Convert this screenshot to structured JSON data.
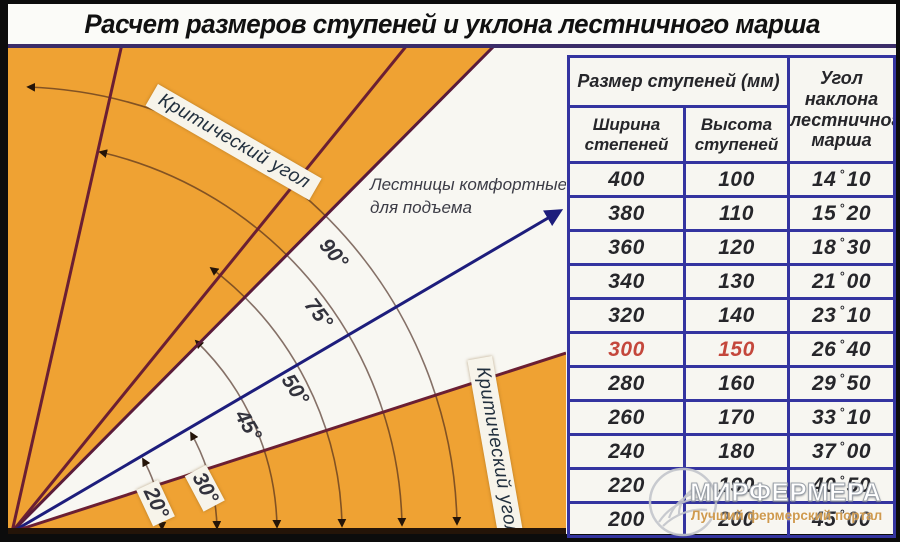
{
  "title": "Расчет размеров ступеней и уклона лестничного марша",
  "table": {
    "header_size": "Размер ступеней (мм)",
    "header_angle": "Угол наклона лестничного марша",
    "sub_width": "Ширина степеней",
    "sub_height": "Высота ступеней",
    "degree_symbol": "°",
    "rows": [
      {
        "w": "400",
        "h": "100",
        "deg": "14",
        "min": "10"
      },
      {
        "w": "380",
        "h": "110",
        "deg": "15",
        "min": "20"
      },
      {
        "w": "360",
        "h": "120",
        "deg": "18",
        "min": "30"
      },
      {
        "w": "340",
        "h": "130",
        "deg": "21",
        "min": "00"
      },
      {
        "w": "320",
        "h": "140",
        "deg": "23",
        "min": "10"
      },
      {
        "w": "300",
        "h": "150",
        "deg": "26",
        "min": "40",
        "highlight": true
      },
      {
        "w": "280",
        "h": "160",
        "deg": "29",
        "min": "50"
      },
      {
        "w": "260",
        "h": "170",
        "deg": "33",
        "min": "10"
      },
      {
        "w": "240",
        "h": "180",
        "deg": "37",
        "min": "00"
      },
      {
        "w": "220",
        "h": "190",
        "deg": "40",
        "min": "50"
      },
      {
        "w": "200",
        "h": "200",
        "deg": "45",
        "min": "00"
      }
    ]
  },
  "diagram": {
    "critical_top": "Критический угол",
    "critical_bottom": "Критический угол",
    "comfort_line1": "Лестницы комфортные",
    "comfort_line2": "для подъема",
    "angle_labels": [
      "90°",
      "75°",
      "50°",
      "45°",
      "30°",
      "20°"
    ]
  },
  "watermark": {
    "name": "МИРФЕРМЕРА",
    "tagline": "Лучший фермерский портал"
  },
  "colors": {
    "panel_orange": "#efa233",
    "frame_purple": "#3b2d69",
    "table_border": "#3434a0",
    "highlight_red": "#c4473c",
    "ray_maroon": "#6b1f33",
    "ray_navy": "#1d1d7c",
    "comfort_white": "#f8f7f2",
    "watermark_tagline": "#cf9a4e"
  }
}
